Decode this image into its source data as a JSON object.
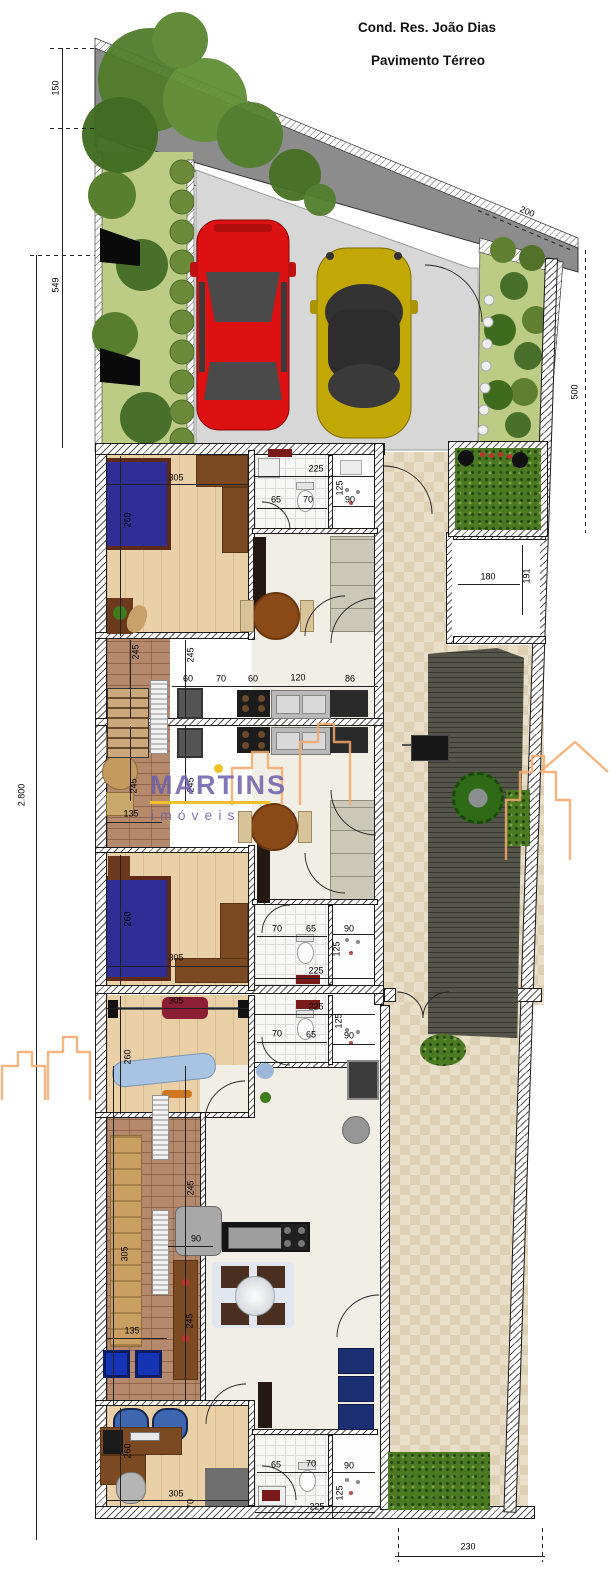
{
  "title": {
    "line1": "Cond. Res. João Dias",
    "line2": "Pavimento Térreo"
  },
  "watermark": {
    "brand": "MARTINS",
    "tagline": "imóveis",
    "brand_color": "#6c5eac",
    "accent_color": "#f0c028",
    "skyline_color": "#f5a86b"
  },
  "colors": {
    "street": "#8c8c8c",
    "driveway": "#d7d7d7",
    "car_red": "#dd1111",
    "car_yellow": "#c2a805",
    "bed_blue": "#2e2e96",
    "hedge_green": "#4c7a22"
  },
  "dimension_labels": [
    {
      "text": "150",
      "x": 56,
      "y": 88,
      "rot": -90
    },
    {
      "text": "549",
      "x": 56,
      "y": 285,
      "rot": -90
    },
    {
      "text": "2.800",
      "x": 22,
      "y": 795,
      "rot": -90
    },
    {
      "text": "200",
      "x": 527,
      "y": 212,
      "rot": 23
    },
    {
      "text": "500",
      "x": 575,
      "y": 392,
      "rot": -90
    },
    {
      "text": "230",
      "x": 468,
      "y": 1547,
      "rot": 0
    },
    {
      "text": "305",
      "x": 176,
      "y": 478,
      "rot": 0
    },
    {
      "text": "260",
      "x": 128,
      "y": 520,
      "rot": -90
    },
    {
      "text": "225",
      "x": 316,
      "y": 469,
      "rot": 0
    },
    {
      "text": "125",
      "x": 340,
      "y": 488,
      "rot": -90
    },
    {
      "text": "65",
      "x": 276,
      "y": 500,
      "rot": 0
    },
    {
      "text": "70",
      "x": 308,
      "y": 500,
      "rot": 0
    },
    {
      "text": "90",
      "x": 350,
      "y": 500,
      "rot": 0
    },
    {
      "text": "245",
      "x": 136,
      "y": 652,
      "rot": -90
    },
    {
      "text": "245",
      "x": 191,
      "y": 655,
      "rot": -90
    },
    {
      "text": "60",
      "x": 188,
      "y": 679,
      "rot": 0
    },
    {
      "text": "70",
      "x": 221,
      "y": 679,
      "rot": 0
    },
    {
      "text": "60",
      "x": 253,
      "y": 679,
      "rot": 0
    },
    {
      "text": "120",
      "x": 298,
      "y": 678,
      "rot": 0
    },
    {
      "text": "86",
      "x": 350,
      "y": 679,
      "rot": 0
    },
    {
      "text": "245",
      "x": 134,
      "y": 786,
      "rot": -90
    },
    {
      "text": "135",
      "x": 131,
      "y": 814,
      "rot": 0
    },
    {
      "text": "245",
      "x": 191,
      "y": 785,
      "rot": -90
    },
    {
      "text": "260",
      "x": 128,
      "y": 919,
      "rot": -90
    },
    {
      "text": "305",
      "x": 176,
      "y": 958,
      "rot": 0
    },
    {
      "text": "70",
      "x": 277,
      "y": 929,
      "rot": 0
    },
    {
      "text": "65",
      "x": 311,
      "y": 929,
      "rot": 0
    },
    {
      "text": "90",
      "x": 349,
      "y": 929,
      "rot": 0
    },
    {
      "text": "125",
      "x": 337,
      "y": 949,
      "rot": -90
    },
    {
      "text": "225",
      "x": 316,
      "y": 971,
      "rot": 0
    },
    {
      "text": "225",
      "x": 316,
      "y": 1007,
      "rot": 0
    },
    {
      "text": "70",
      "x": 277,
      "y": 1034,
      "rot": 0
    },
    {
      "text": "65",
      "x": 311,
      "y": 1035,
      "rot": 0
    },
    {
      "text": "90",
      "x": 349,
      "y": 1036,
      "rot": 0
    },
    {
      "text": "125",
      "x": 339,
      "y": 1021,
      "rot": -90
    },
    {
      "text": "305",
      "x": 176,
      "y": 1001,
      "rot": 0
    },
    {
      "text": "260",
      "x": 128,
      "y": 1057,
      "rot": -90
    },
    {
      "text": "245",
      "x": 191,
      "y": 1188,
      "rot": -90
    },
    {
      "text": "305",
      "x": 125,
      "y": 1254,
      "rot": -90
    },
    {
      "text": "90",
      "x": 196,
      "y": 1239,
      "rot": 0
    },
    {
      "text": "245",
      "x": 190,
      "y": 1321,
      "rot": -90
    },
    {
      "text": "135",
      "x": 132,
      "y": 1331,
      "rot": 0
    },
    {
      "text": "260",
      "x": 128,
      "y": 1451,
      "rot": -90
    },
    {
      "text": "305",
      "x": 176,
      "y": 1494,
      "rot": 0
    },
    {
      "text": "70",
      "x": 191,
      "y": 1504,
      "rot": -90
    },
    {
      "text": "65",
      "x": 276,
      "y": 1465,
      "rot": 0
    },
    {
      "text": "70",
      "x": 311,
      "y": 1464,
      "rot": 0
    },
    {
      "text": "90",
      "x": 349,
      "y": 1466,
      "rot": 0
    },
    {
      "text": "125",
      "x": 340,
      "y": 1493,
      "rot": -90
    },
    {
      "text": "225",
      "x": 317,
      "y": 1507,
      "rot": 0
    },
    {
      "text": "180",
      "x": 488,
      "y": 577,
      "rot": 0
    },
    {
      "text": "191",
      "x": 527,
      "y": 576,
      "rot": -90
    }
  ]
}
